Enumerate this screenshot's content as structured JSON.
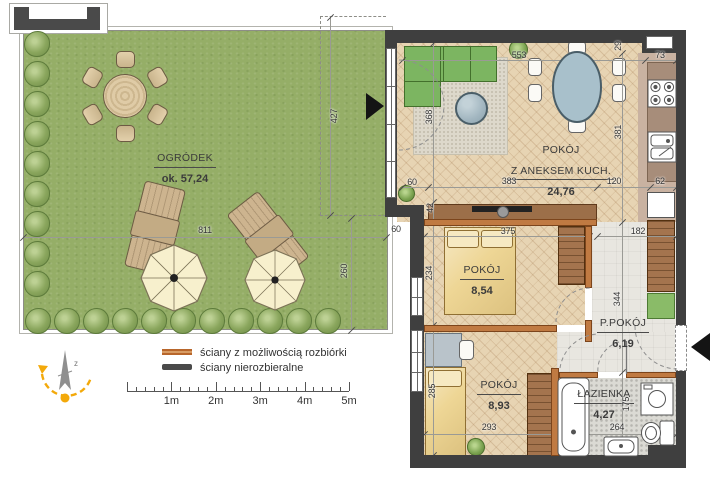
{
  "title": "Rzut mieszkania z ogródkiem",
  "garden": {
    "name": "OGRÓDEK",
    "area": "ok. 57,24"
  },
  "rooms": {
    "living": {
      "name": "POKÓJ",
      "name2": "Z ANEKSEM KUCH.",
      "area": "24,76"
    },
    "bedroom1": {
      "name": "POKÓJ",
      "area": "8,54"
    },
    "hall": {
      "name": "P.POKÓJ",
      "area": "6,19"
    },
    "bedroom2": {
      "name": "POKÓJ",
      "area": "8,93"
    },
    "bathroom": {
      "name": "ŁAZIENKA",
      "area": "4,27"
    }
  },
  "dimensions_cm": [
    {
      "name": "garden-width",
      "value": "811",
      "x": 205,
      "y": 230,
      "rot": 0
    },
    {
      "name": "garden-depth-upper",
      "value": "427",
      "x": 334,
      "y": 116,
      "rot": -90
    },
    {
      "name": "garden-depth-lower",
      "value": "260",
      "x": 344,
      "y": 271,
      "rot": -90
    },
    {
      "name": "step-width",
      "value": "60",
      "x": 396,
      "y": 229,
      "rot": 0
    },
    {
      "name": "niche-width",
      "value": "60",
      "x": 412,
      "y": 182,
      "rot": 0
    },
    {
      "name": "living-width",
      "value": "553",
      "x": 519,
      "y": 55,
      "rot": 0
    },
    {
      "name": "corner-offset",
      "value": "29",
      "x": 618,
      "y": 46,
      "rot": -90
    },
    {
      "name": "kitchen-top",
      "value": "73",
      "x": 660,
      "y": 55,
      "rot": 0
    },
    {
      "name": "living-depth",
      "value": "368",
      "x": 429,
      "y": 117,
      "rot": -90
    },
    {
      "name": "kitchen-depth",
      "value": "381",
      "x": 618,
      "y": 132,
      "rot": -90
    },
    {
      "name": "living-bottom",
      "value": "383",
      "x": 509,
      "y": 181,
      "rot": 0
    },
    {
      "name": "kitchen-bottom",
      "value": "120",
      "x": 614,
      "y": 181,
      "rot": 0
    },
    {
      "name": "counter-width",
      "value": "62",
      "x": 660,
      "y": 181,
      "rot": 0
    },
    {
      "name": "sideboard-depth",
      "value": "42",
      "x": 430,
      "y": 208,
      "rot": -90
    },
    {
      "name": "bedroom1-width",
      "value": "375",
      "x": 508,
      "y": 231,
      "rot": 0
    },
    {
      "name": "hall-width",
      "value": "182",
      "x": 638,
      "y": 231,
      "rot": 0
    },
    {
      "name": "bedroom1-depth",
      "value": "234",
      "x": 429,
      "y": 273,
      "rot": -90
    },
    {
      "name": "hall-depth",
      "value": "344",
      "x": 617,
      "y": 299,
      "rot": -90
    },
    {
      "name": "bed2-length",
      "value": "285",
      "x": 432,
      "y": 391,
      "rot": -90
    },
    {
      "name": "bedroom2-width",
      "value": "293",
      "x": 489,
      "y": 427,
      "rot": 0
    },
    {
      "name": "bathroom-width",
      "value": "264",
      "x": 617,
      "y": 427,
      "rot": 0
    },
    {
      "name": "bathroom-depth",
      "value": "175",
      "x": 626,
      "y": 404,
      "rot": -90
    }
  ],
  "legend": {
    "items": [
      {
        "label": "ściany z możliwością rozbiórki",
        "color": "#c07a42"
      },
      {
        "label": "ściany nierozbieralne",
        "color": "#4a4a4a"
      }
    ]
  },
  "scale_bar": {
    "labels": [
      "1m",
      "2m",
      "3m",
      "4m",
      "5m"
    ]
  },
  "colors": {
    "garden_green": "#95ae67",
    "wall_dark": "#3f3f3f",
    "wall_removable_orange": "#c07a42",
    "wood_floor": "#e7d4b3",
    "sofa_green": "#7cb561",
    "north_gold": "#f3a90a"
  }
}
